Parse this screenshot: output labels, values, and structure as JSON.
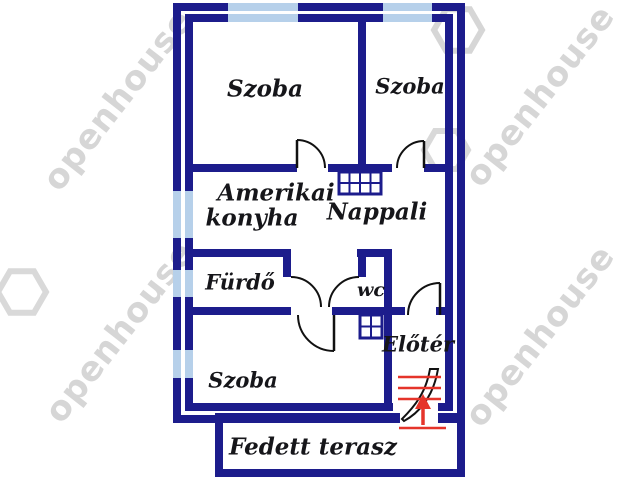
{
  "plan": {
    "rooms": {
      "szoba_top_left": "Szoba",
      "szoba_top_right": "Szoba",
      "kitchen_line1": "Amerikai",
      "kitchen_line2": "konyha",
      "nappali": "Nappali",
      "furdo": "Fürdő",
      "wc": "wc",
      "eloter": "Előtér",
      "szoba_bottom": "Szoba",
      "terrace": "Fedett terasz"
    },
    "icons": {
      "entrance_arrow": "up-arrow",
      "stairs": "red-step-lines",
      "window": "light-blue-wall-segment",
      "grid_symbol": "masonry-grid"
    },
    "colors": {
      "wall": "#1c1c8c",
      "window": "#b6d0ea",
      "accent_red": "#e5342a",
      "label": "#16161a",
      "watermark": "#cfcfcf",
      "background": "#ffffff"
    }
  },
  "watermark": {
    "text": "openhouse"
  }
}
